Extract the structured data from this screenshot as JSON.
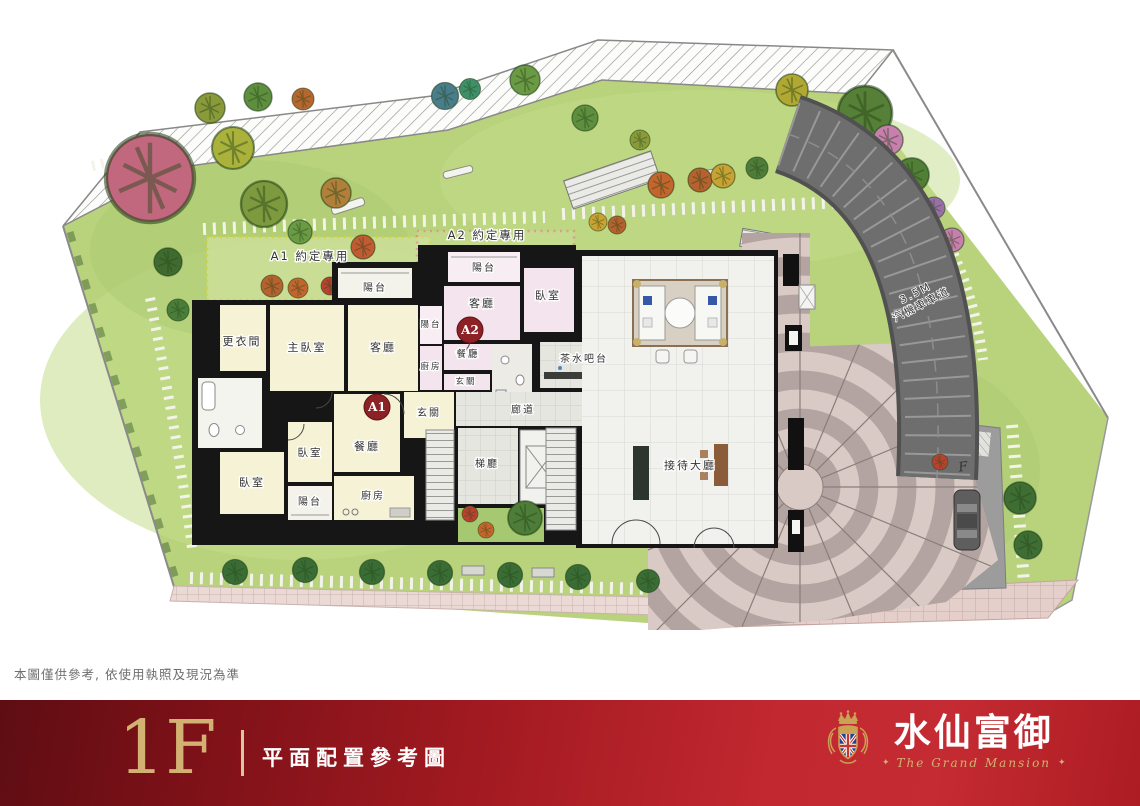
{
  "theme": {
    "gold": "#d2b173",
    "banner-dark": "#5e0d13",
    "banner-red": "#c22830",
    "lawn": "#b8d37c",
    "a1-fill": "#f6f2d5",
    "a2-fill": "#f4e4ee",
    "badge-red": "#8c2126",
    "ramp-gray": "#6e6e6e",
    "plaza-light": "#d9cac5",
    "plaza-dark": "#b3a4a1"
  },
  "plan": {
    "area_labels": {
      "a1_exclusive": "A1 約定專用",
      "a2_exclusive": "A2 約定專用",
      "ramp_width": "3.5M",
      "ramp_name": "汽機車車道",
      "road_marker": "F"
    },
    "unit_a1": {
      "badge": "A1",
      "closet": "更衣間",
      "master_bedroom": "主臥室",
      "living_room": "客廳",
      "balcony_top": "陽台",
      "entry": "玄關",
      "dining_room": "餐廳",
      "bedroom_1": "臥室",
      "bedroom_2": "臥室",
      "balcony_bottom": "陽台",
      "kitchen": "廚房"
    },
    "unit_a2": {
      "badge": "A2",
      "balcony_top": "陽台",
      "balcony_side": "陽台",
      "living_room": "客廳",
      "bedroom": "臥室",
      "dining_room": "餐廳",
      "kitchen": "廚房",
      "entry": "玄關"
    },
    "common": {
      "tea_bar": "茶水吧台",
      "corridor": "廊道",
      "elevator_lobby": "梯廳",
      "reception_hall": "接待大廳"
    }
  },
  "disclaimer": "本圖僅供參考, 依使用執照及現況為準",
  "footer": {
    "floor": "1F",
    "subtitle": "平面配置參考圖",
    "brand_name": "水仙富御",
    "brand_tagline": "The Grand Mansion",
    "ornament_left": "✦",
    "ornament_right": "✦"
  }
}
